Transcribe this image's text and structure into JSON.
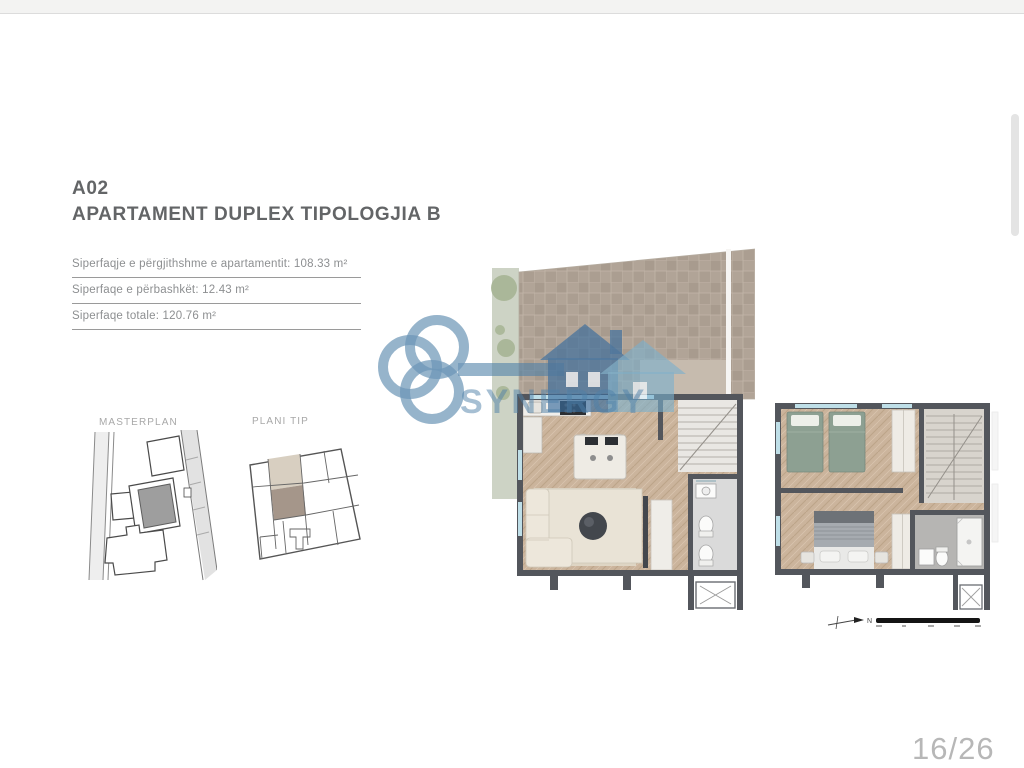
{
  "header": {
    "code": "A02",
    "title": "APARTAMENT DUPLEX TIPOLOGJIA B"
  },
  "areas": [
    {
      "label": "Siperfaqje e përgjithshme e apartamentit: 108.33 m²"
    },
    {
      "label": "Siperfaqe e përbashkët: 12.43 m²"
    },
    {
      "label": "Siperfaqe totale: 120.76 m²"
    }
  ],
  "thumbnails": {
    "masterplan_label": "MASTERPLAN",
    "plani_tip_label": "PLANI TIP"
  },
  "logo": {
    "text": "SYNERGY",
    "brand_blue": "#4d7fa8"
  },
  "scale": {
    "north_label": "N"
  },
  "footer": {
    "page_number": "16/26"
  },
  "colors": {
    "wall": "#53565c",
    "wood_floor": "#cbb49c",
    "terrace_tile": "#b1a497",
    "landscape_green": "#cdd3c5",
    "bed_green": "#8da092",
    "highlight_unit": "#a5968a",
    "window_blue": "#bfdfe8",
    "page_number_gray": "#b7b7b7"
  }
}
